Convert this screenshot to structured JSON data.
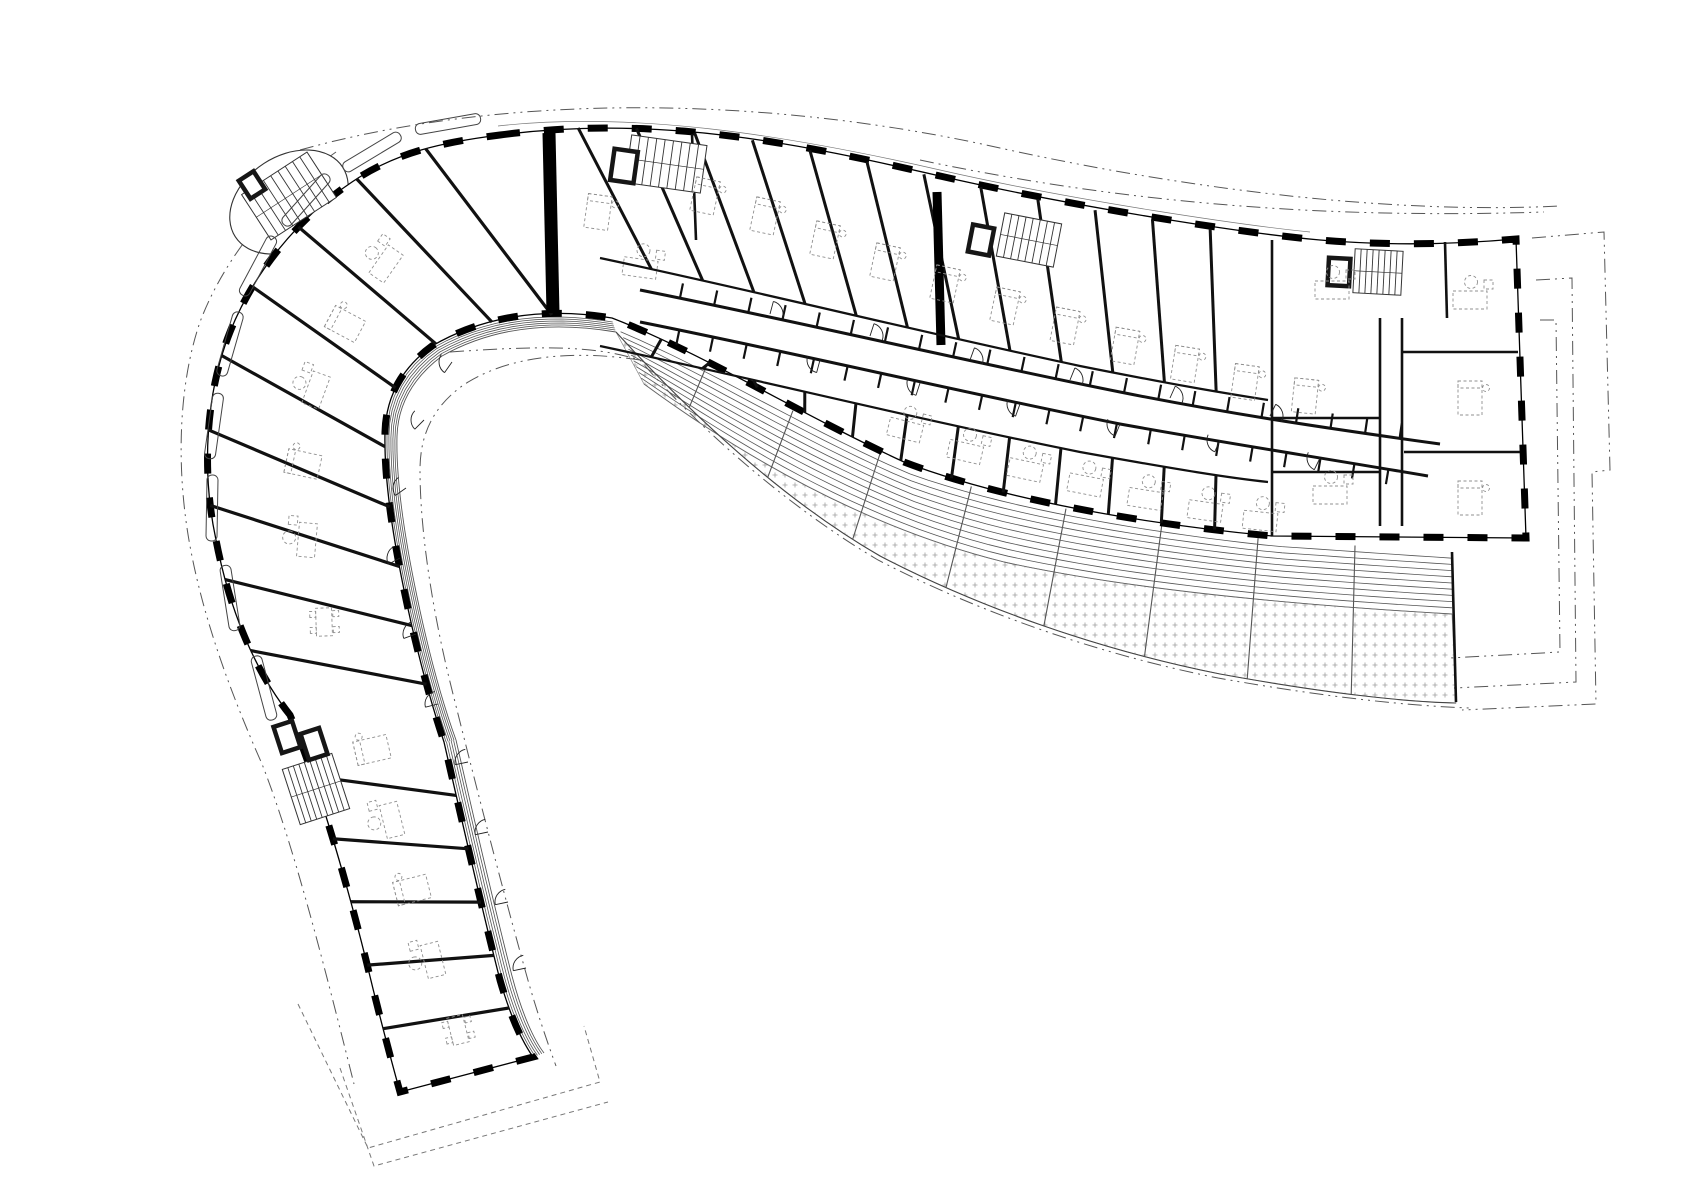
{
  "meta": {
    "title": "Curved residential building floor plan",
    "drawing_type": "architectural-floor-plan",
    "visible_text": []
  },
  "colors": {
    "ink": "#111111",
    "wall": "#000000",
    "thin": "#333333",
    "hatch_line": "#555555",
    "gravel_dot": "#a0a0a0",
    "furniture": "#8f8f8f",
    "site_line": "#555555",
    "roof_dash": "#777777",
    "bg": "#ffffff"
  },
  "canvas": {
    "w": 1697,
    "h": 1200
  },
  "geometry": {
    "outline": "M 500 135 C 660 114 800 144 940 176 C 1080 208 1250 234 1320 240 C 1390 246 1460 244 1516 239 L 1526 538 L 1272 536 C 1144 524 1004 500 904 462 C 804 416 700 352 612 318 C 540 306 480 318 432 346 C 402 368 386 396 385 432 C 384 472 390 520 402 580 C 414 640 428 694 444 742 C 460 812 482 910 500 980 C 512 1022 524 1044 533 1057 L 400 1092 C 390 1056 378 1010 366 960 C 346 880 318 782 290 715 C 254 670 229 608 216 540 C 201 470 206 392 230 332 C 254 272 298 218 352 182 C 396 152 444 142 500 135 Z",
    "guides": {
      "bar_top": "M 520 132 C 660 116 800 146 940 178 C 1080 210 1180 226 1268 236",
      "bar_south": "M 612 318 C 700 352 804 416 904 462 C 1004 500 1144 524 1268 535",
      "top_off": "M 498 126 C 640 110 800 138 940 170 C 1080 202 1250 226 1310 232",
      "corridor_upper": "M 640 290 C 800 322 960 360 1120 392 C 1220 412 1310 426 1440 444",
      "corridor_lower": "M 640 322 C 800 354 960 392 1120 424 C 1220 442 1310 456 1428 476",
      "bath_upper": "M 600 258 C 760 292 920 332 1080 366 C 1180 386 1230 394 1268 400",
      "bath_lower": "M 600 346 C 760 380 920 420 1080 452 C 1180 470 1230 478 1268 482",
      "hook_outer": "M 500 135 C 444 142 396 152 352 182 C 298 218 254 272 230 332 C 206 392 201 470 216 540 C 229 608 254 670 290 715",
      "hook_inner": "M 612 320 C 540 308 480 318 432 346 C 402 368 386 396 385 432 C 384 472 390 520 402 580 C 414 640 428 694 444 742",
      "hook_inner2": "M 616 332 C 546 320 488 330 442 356 C 414 377 398 404 397 436 C 396 474 402 522 414 582 C 426 642 440 696 456 740",
      "arm_outer": "M 290 715 C 318 782 346 880 366 960 C 378 1010 390 1056 400 1092",
      "arm_inner": "M 444 742 C 460 812 482 910 500 980 C 512 1022 524 1044 533 1057",
      "arm_inner2": "M 456 740 C 472 810 494 906 512 976 C 522 1014 534 1040 544 1053",
      "terrace_top": "M 618 326 C 706 360 806 422 906 466 C 1006 502 1146 526 1274 540 L 1452 552",
      "terrace_mid": "M 644 384 C 764 472 884 532 1004 562 C 1104 584 1244 602 1452 614",
      "terrace_outer": "M 616 332 C 702 426 790 504 880 556 C 980 608 1100 650 1220 674 C 1330 694 1408 702 1456 703"
    },
    "heavy_walls": [
      [
        549,
        133,
        553,
        313,
        13
      ],
      [
        937,
        192,
        941,
        345,
        9
      ]
    ],
    "block_walls": [
      [
        1272,
        240,
        1272,
        536
      ],
      [
        1380,
        318,
        1380,
        526
      ],
      [
        1402,
        318,
        1402,
        526
      ],
      [
        1402,
        352,
        1518,
        352
      ],
      [
        1404,
        452,
        1520,
        452
      ],
      [
        1272,
        418,
        1380,
        418
      ],
      [
        1272,
        472,
        1380,
        472
      ],
      [
        1445,
        242,
        1447,
        318
      ],
      [
        692,
        134,
        696,
        240
      ],
      [
        1452,
        552,
        1456,
        702
      ]
    ]
  },
  "counts": {
    "bar_dividers": 13,
    "hook_dividers": 10,
    "arm_dividers": 6,
    "terrace_dividers": 9,
    "corridor_teeth": 22,
    "deck_lines": 9,
    "stripe_lines_hook": 5,
    "stripe_lines_arm": 4
  },
  "stair_tower": {
    "cx": 289,
    "cy": 202,
    "rx": 64,
    "ry": 46,
    "rot": -33
  },
  "stairs": [
    [
      289,
      196,
      78,
      54,
      -33,
      9
    ],
    [
      666,
      164,
      76,
      48,
      8,
      9
    ],
    [
      1029,
      240,
      58,
      44,
      11,
      8
    ],
    [
      1378,
      272,
      48,
      44,
      3,
      8
    ],
    [
      316,
      789,
      52,
      58,
      -18,
      9
    ]
  ],
  "elevators": [
    [
      624,
      166,
      28,
      36,
      8
    ],
    [
      981,
      240,
      26,
      32,
      11
    ],
    [
      1339,
      272,
      26,
      32,
      3
    ],
    [
      287,
      737,
      24,
      32,
      -18
    ],
    [
      314,
      744,
      24,
      32,
      -18
    ],
    [
      252,
      185,
      22,
      26,
      -33
    ]
  ],
  "balconies": [
    [
      448,
      124,
      -10
    ],
    [
      372,
      152,
      -31
    ],
    [
      306,
      200,
      -48
    ],
    [
      258,
      266,
      -62
    ],
    [
      230,
      344,
      -74
    ],
    [
      214,
      426,
      -82
    ],
    [
      212,
      508,
      -89
    ],
    [
      230,
      598,
      -99
    ],
    [
      264,
      688,
      -105
    ]
  ],
  "furniture": [
    [
      "bed",
      705,
      196,
      12
    ],
    [
      "bed",
      765,
      216,
      12
    ],
    [
      "bed",
      825,
      240,
      12
    ],
    [
      "bed",
      885,
      262,
      12
    ],
    [
      "bed",
      945,
      284,
      12
    ],
    [
      "bed",
      1005,
      306,
      12
    ],
    [
      "bed",
      1065,
      326,
      11
    ],
    [
      "bed",
      1125,
      346,
      10
    ],
    [
      "bed",
      1185,
      364,
      9
    ],
    [
      "bed",
      1245,
      382,
      8
    ],
    [
      "bed",
      1305,
      396,
      6
    ],
    [
      "liv",
      905,
      430,
      14
    ],
    [
      "liv",
      965,
      452,
      13
    ],
    [
      "liv",
      1025,
      470,
      12
    ],
    [
      "liv",
      1085,
      485,
      11
    ],
    [
      "liv",
      1145,
      499,
      9
    ],
    [
      "liv",
      1205,
      511,
      8
    ],
    [
      "liv",
      1260,
      521,
      6
    ],
    [
      "liv",
      640,
      268,
      8
    ],
    [
      "bed",
      598,
      212,
      8
    ],
    [
      "liv",
      1332,
      290,
      0
    ],
    [
      "liv",
      1470,
      300,
      0
    ],
    [
      "bed",
      1470,
      398,
      0
    ],
    [
      "bed",
      1470,
      498,
      0
    ],
    [
      "liv",
      1330,
      495,
      0
    ],
    [
      "liv",
      386,
      264,
      -55
    ],
    [
      "bed",
      345,
      324,
      -62
    ],
    [
      "liv",
      316,
      390,
      -70
    ],
    [
      "bed",
      303,
      464,
      -78
    ],
    [
      "liv",
      307,
      540,
      -85
    ],
    [
      "din",
      324,
      622,
      -92
    ],
    [
      "bed",
      372,
      750,
      -103
    ],
    [
      "liv",
      392,
      820,
      -104
    ],
    [
      "bed",
      412,
      890,
      -104
    ],
    [
      "liv",
      433,
      960,
      -104
    ],
    [
      "din",
      458,
      1030,
      -104
    ]
  ],
  "doors": [
    [
      770,
      314,
      -75
    ],
    [
      870,
      336,
      -72
    ],
    [
      970,
      360,
      -70
    ],
    [
      1070,
      380,
      -68
    ],
    [
      1170,
      398,
      -66
    ],
    [
      1270,
      416,
      -64
    ],
    [
      820,
      360,
      105
    ],
    [
      920,
      383,
      108
    ],
    [
      1020,
      404,
      110
    ],
    [
      1120,
      424,
      112
    ],
    [
      1220,
      440,
      114
    ],
    [
      1320,
      458,
      116
    ],
    [
      452,
      362,
      125
    ],
    [
      424,
      420,
      135
    ],
    [
      406,
      488,
      145
    ],
    [
      400,
      558,
      152
    ],
    [
      416,
      634,
      160
    ],
    [
      438,
      704,
      166
    ],
    [
      468,
      762,
      168
    ],
    [
      488,
      832,
      168
    ],
    [
      508,
      902,
      168
    ],
    [
      526,
      968,
      168
    ]
  ],
  "overlays": {
    "dashdot": [
      "M 300 150 C 500 94 760 94 1000 148 C 1200 192 1400 214 1560 206",
      "M 920 160 C 1100 198 1300 220 1544 212",
      "M 450 352 C 560 344 600 348 640 360 C 700 430 790 508 878 560 C 978 612 1098 654 1218 678 C 1330 698 1412 706 1470 708",
      "M 640 360 C 560 348 500 360 462 386 C 432 408 420 436 420 470 C 420 530 432 610 452 690 C 472 770 500 880 524 966 C 536 1010 548 1044 556 1066",
      "M 336 152 C 276 194 224 258 200 322 C 178 386 176 470 190 546 C 204 622 232 696 262 764 C 292 840 322 956 354 1084",
      "M 1532 238 L 1604 232 L 1610 470 L 1592 472 L 1596 704 L 1462 710",
      "M 1536 280 L 1572 278 L 1576 682 L 1454 688",
      "M 1540 320 L 1556 320 L 1560 652 L 1450 658"
    ],
    "dashed": [
      "M 298 1004 L 368 1148 L 600 1082 L 584 1026",
      "M 340 1068 L 374 1166 L 608 1102"
    ]
  }
}
